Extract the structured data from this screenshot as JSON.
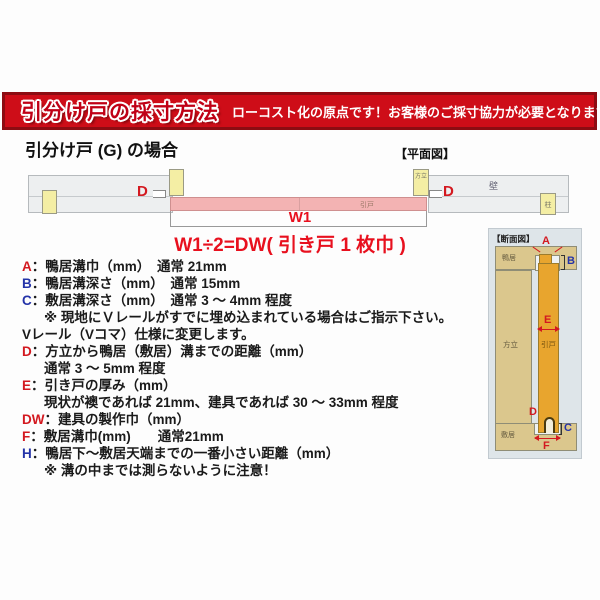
{
  "banner": {
    "title": "引分け戸の採寸方法",
    "message": "ローコスト化の原点です！お客様のご採寸協力が必要となります！"
  },
  "page": {
    "subtitle": "引分け戸 (G) の場合"
  },
  "plan_view": {
    "caption": "【平面図】",
    "wall_label": "壁",
    "pillar_label": "柱",
    "hodate_label": "方立",
    "door_label": "引戸",
    "d_label": "D",
    "w1_label": "W1",
    "formula": "W1÷2=DW( 引き戸 1 枚巾 )"
  },
  "section_view": {
    "caption": "【断面図】",
    "kamoi_label": "鴨居",
    "hodate_label": "方立",
    "door_label": "引戸",
    "shikii_label": "敷居",
    "a_label": "A",
    "b_label": "B",
    "c_label": "C",
    "d_label": "D",
    "e_label": "E",
    "f_label": "F"
  },
  "colors": {
    "banner_bg": "#ce0d18",
    "banner_border": "#8d0c12",
    "red_key": "#d31920",
    "blue_key": "#2433a8",
    "door_pink": "#f3b3b3",
    "wood_tan": "#dbc78d",
    "door_orange": "#e8a52e",
    "post_yellow": "#f4eea4"
  },
  "measure_list": {
    "rows": [
      {
        "key": "A",
        "key_color": "#d31920",
        "text": "：鴨居溝巾（mm）　通常 21mm",
        "indent": false
      },
      {
        "key": "B",
        "key_color": "#2433a8",
        "text": "：鴨居溝深さ（mm）　通常 15mm",
        "indent": false
      },
      {
        "key": "C",
        "key_color": "#2433a8",
        "text": "：敷居溝深さ（mm）　通常 3 ～ 4mm 程度",
        "indent": false
      },
      {
        "key": null,
        "key_color": null,
        "text": "※ 現地にＶレールがすでに埋め込まれている場合はご指示下さい。",
        "indent": true
      },
      {
        "key": null,
        "key_color": null,
        "text": "Vレール（Vコマ）仕様に変更します。",
        "indent": false
      },
      {
        "key": "D",
        "key_color": "#d31920",
        "text": "：方立から鴨居（敷居）溝までの距離（mm）",
        "indent": false
      },
      {
        "key": null,
        "key_color": null,
        "text": "通常 3 ～ 5mm 程度",
        "indent": true
      },
      {
        "key": "E",
        "key_color": "#d31920",
        "text": "：引き戸の厚み（mm）",
        "indent": false
      },
      {
        "key": null,
        "key_color": null,
        "text": "現状が襖であれば 21mm、建具であれば 30 ～ 33mm 程度",
        "indent": true
      },
      {
        "key": "DW",
        "key_color": "#d31920",
        "text": "：建具の製作巾（mm）",
        "indent": false
      },
      {
        "key": "F",
        "key_color": "#d31920",
        "text": "：敷居溝巾(mm)　　通常21mm",
        "indent": false
      },
      {
        "key": "H",
        "key_color": "#2433a8",
        "text": "：鴨居下～敷居天端までの一番小さい距離（mm）",
        "indent": false
      },
      {
        "key": null,
        "key_color": null,
        "text": "※ 溝の中までは測らないように注意！",
        "indent": true
      }
    ]
  }
}
